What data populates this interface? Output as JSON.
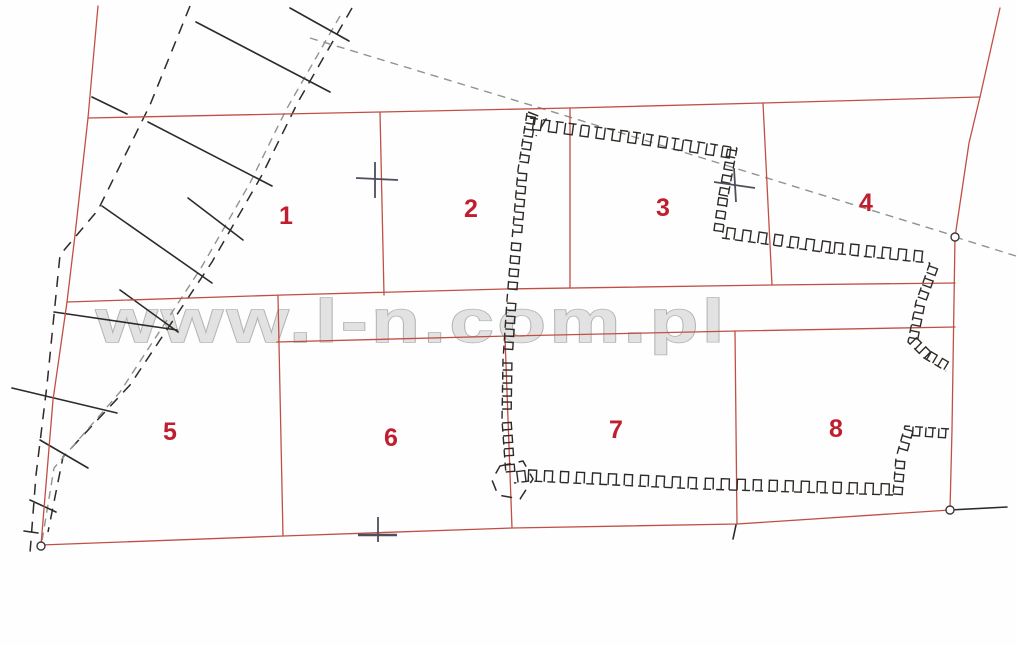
{
  "map": {
    "title": "cadastral-parcel-sketch",
    "watermark": "www.l-n.com.pl",
    "parcels": [
      {
        "label": "1"
      },
      {
        "label": "2"
      },
      {
        "label": "3"
      },
      {
        "label": "4"
      },
      {
        "label": "5"
      },
      {
        "label": "6"
      },
      {
        "label": "7"
      },
      {
        "label": "8"
      }
    ],
    "symbols": {
      "boundary_lines": "red-parcel-boundary",
      "hatched_band": "road-embankment-band",
      "crenellated_line": "fence-hedge-symbol",
      "dashed_gray_line": "auxiliary-survey-line",
      "plus_marks": "survey-cross",
      "small_circles": "boundary-point"
    }
  },
  "colors": {
    "boundary_red": "#c14f45",
    "ink_black": "#2e2a28",
    "dashed_gray": "#8e958f",
    "cross_gray": "#4f4f5c",
    "label_red": "#bf1e2e",
    "watermark_gray": "#e0e0e0",
    "background": "#fefefe"
  }
}
